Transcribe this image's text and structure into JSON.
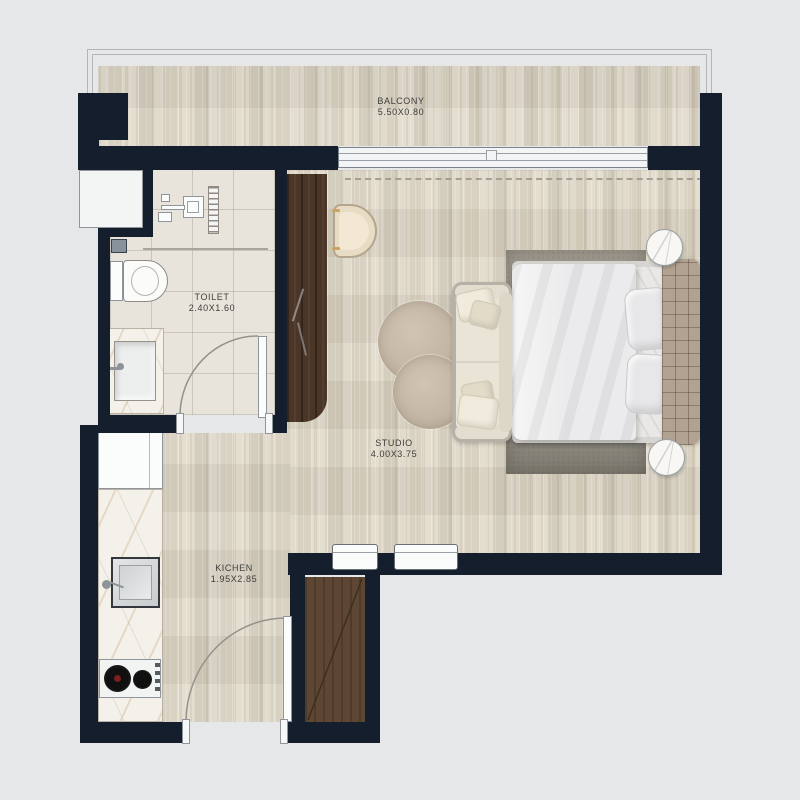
{
  "rooms": {
    "balcony": {
      "label": "BALCONY",
      "dims": "5.50X0.80"
    },
    "toilet": {
      "label": "TOILET",
      "dims": "2.40X1.60"
    },
    "studio": {
      "label": "STUDIO",
      "dims": "4.00X3.75"
    },
    "kitchen": {
      "label": "KICHEN",
      "dims": "1.95X2.85"
    }
  },
  "palette": {
    "background": "#e6e7e8",
    "wall": "#141e2d",
    "wood_floor": "#ddd6c7",
    "tile_floor": "#e8e4dc",
    "marble": "#f4f1ea",
    "wardrobe_wood": "#4a3527",
    "shaft_wood": "#5d4634",
    "area_rug": "#a19d92",
    "round_rug": "#c2b4a2",
    "headboard": "#b2a291",
    "sofa": "#e9e4d6",
    "door_stroke": "#95918a"
  },
  "symbols": [
    "balcony-railing",
    "sliding-balcony-door",
    "double-bed",
    "tufted-headboard",
    "bedside-table",
    "area-rug",
    "round-rug",
    "sofa",
    "armchair",
    "wardrobe",
    "entry-door",
    "toilet-door",
    "wc-toilet",
    "vanity-sink",
    "shower-set",
    "towel-ladder",
    "service-duct",
    "kitchen-cabinet",
    "kitchen-counter",
    "kitchen-sink",
    "cooktop",
    "duct-shaft",
    "ac-unit"
  ]
}
